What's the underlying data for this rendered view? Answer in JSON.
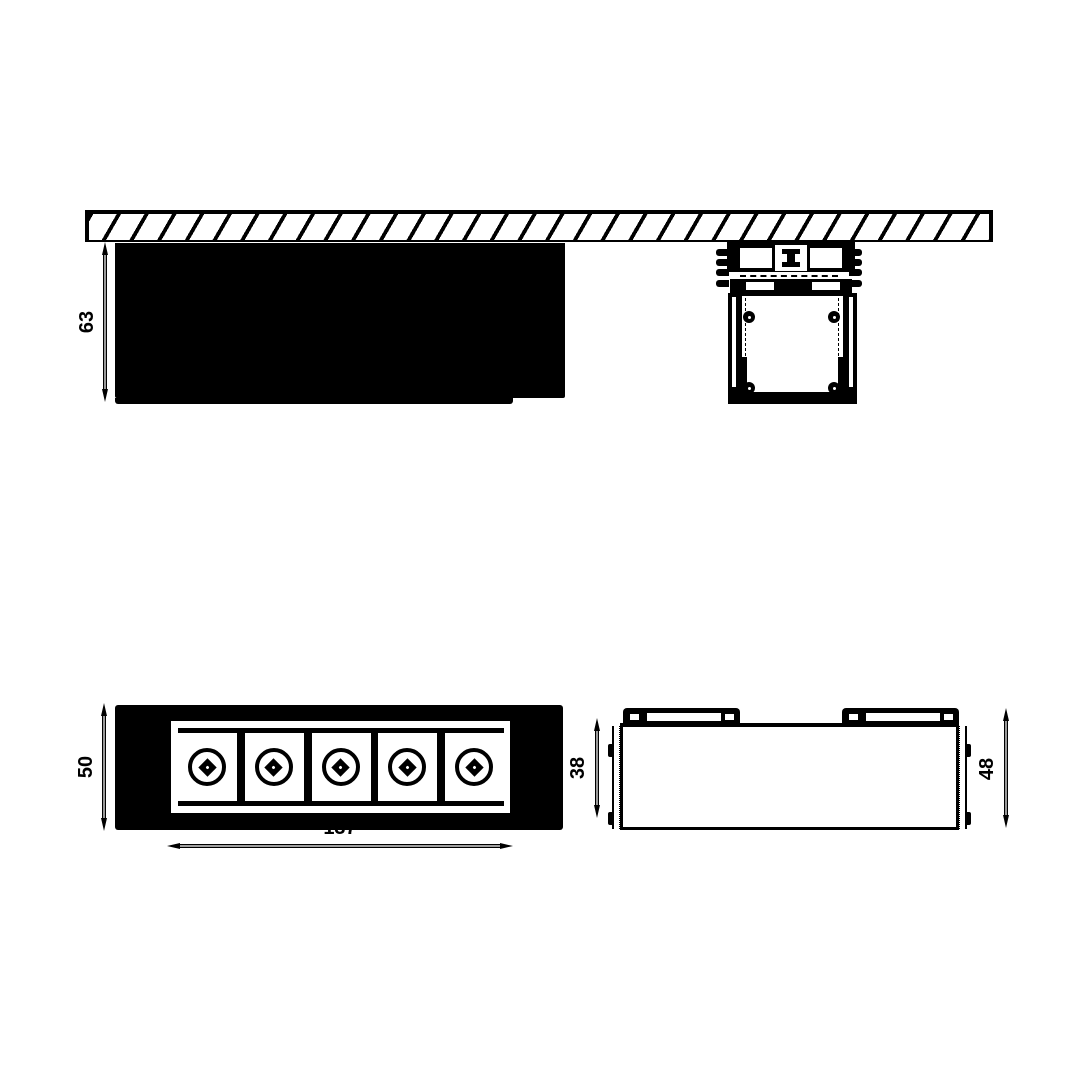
{
  "colors": {
    "background": "#ffffff",
    "line": "#000000"
  },
  "front_view": {
    "led_count": 5
  },
  "dimensions": {
    "fixture_depth": "63",
    "front_height": "50",
    "front_width": "137",
    "side_inner_height": "38",
    "side_overall_height": "48"
  }
}
